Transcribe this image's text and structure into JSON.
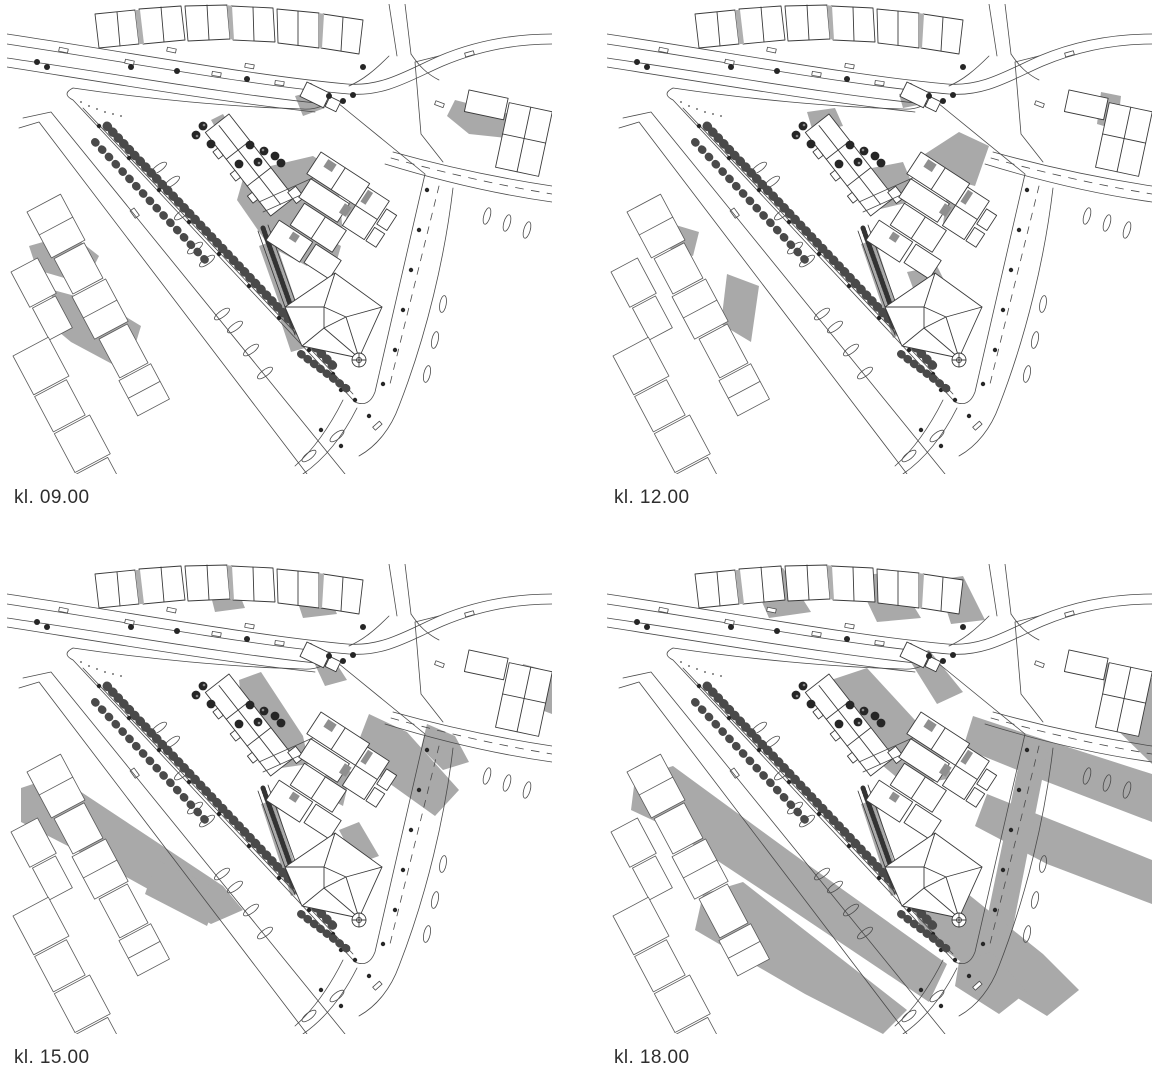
{
  "page": {
    "background": "#ffffff"
  },
  "figure": {
    "type": "sun-shadow-study-site-plan",
    "colors": {
      "shadow": "#a9a9a9",
      "line": "#4a4a4a",
      "building_line": "#3a3a3a",
      "building_fill": "#ffffff",
      "tree": "#262626",
      "dark_roof": "#8f8f8f",
      "label_text": "#2e2e2e"
    },
    "panels": [
      {
        "id": "0900",
        "label": "kl. 09.00",
        "shadows": [
          "448,96 510,112 518,136 462,130 440,112",
          "288,92 310,86 318,104 296,112",
          "204,116 216,110 272,204 258,206 234,168",
          "238,168 306,152 330,168 336,230 300,262 262,242 230,196",
          "252,242 268,236 300,330 286,338",
          "268,300 280,296 298,344 284,348",
          "344,186 362,196 354,232 338,222",
          "316,232 334,242 326,270 310,260",
          "22,242 64,230 92,252 78,280 30,266",
          "46,286 98,300 134,322 120,368 64,338 40,318",
          "196,6 206,4 212,34 200,36",
          "280,10 290,8 296,38 284,40"
        ]
      },
      {
        "id": "1200",
        "label": "kl. 12.00",
        "shadows": [
          "318,150 352,128 382,142 368,182 330,172",
          "244,168 296,158 312,196 260,208",
          "200,108 228,104 236,122 206,128",
          "254,240 268,236 298,328 286,334",
          "300,268 330,262 338,278 306,284",
          "292,90 310,86 316,100 296,104",
          "494,88 514,92 510,126 490,120",
          "52,216 92,228 86,252 48,240",
          "120,270 152,282 144,338 114,320",
          "340,190 356,198 350,228 336,220",
          "196,6 206,4 212,34 200,36"
        ]
      },
      {
        "id": "1500",
        "label": "kl. 15.00",
        "shadows": [
          "14,224 50,212 216,322 236,346 204,360 96,300 14,258",
          "150,296 214,326 200,362 138,330",
          "232,116 254,108 296,172 302,200 260,206 238,168",
          "362,150 400,168 452,226 428,252 372,212 352,176",
          "322,196 344,208 336,242 314,230",
          "332,266 352,258 372,292 350,300",
          "254,240 268,236 296,326 284,332",
          "516,100 545,108 545,150 508,136",
          "198,8 222,4 238,44 208,48",
          "282,12 312,8 330,50 296,54",
          "304,92 322,88 340,116 318,122",
          "420,160 448,172 462,198 436,206 414,184"
        ]
      },
      {
        "id": "1800",
        "label": "kl. 18.00",
        "shadows": [
          "28,214 66,202 200,300 340,400 322,438 176,340 58,262 24,246",
          "96,330 136,318 300,446 276,470 198,430 88,366",
          "224,116 260,104 330,180 346,214 300,222 250,180",
          "366,152 420,170 545,210 545,258 430,214 356,184",
          "380,230 460,262 545,296 545,340 440,300 368,262",
          "418,170 442,180 398,404 372,394",
          "306,344 356,326 436,390 472,426 440,452 368,408 318,372",
          "352,398 384,388 420,428 392,450 348,422",
          "142,8 176,4 204,48 162,54",
          "248,12 286,8 314,54 270,58",
          "330,16 356,12 378,56 344,60",
          "498,98 545,114 545,200 494,150",
          "300,92 322,86 356,128 330,140",
          "254,240 268,236 296,326 284,332"
        ]
      }
    ]
  }
}
